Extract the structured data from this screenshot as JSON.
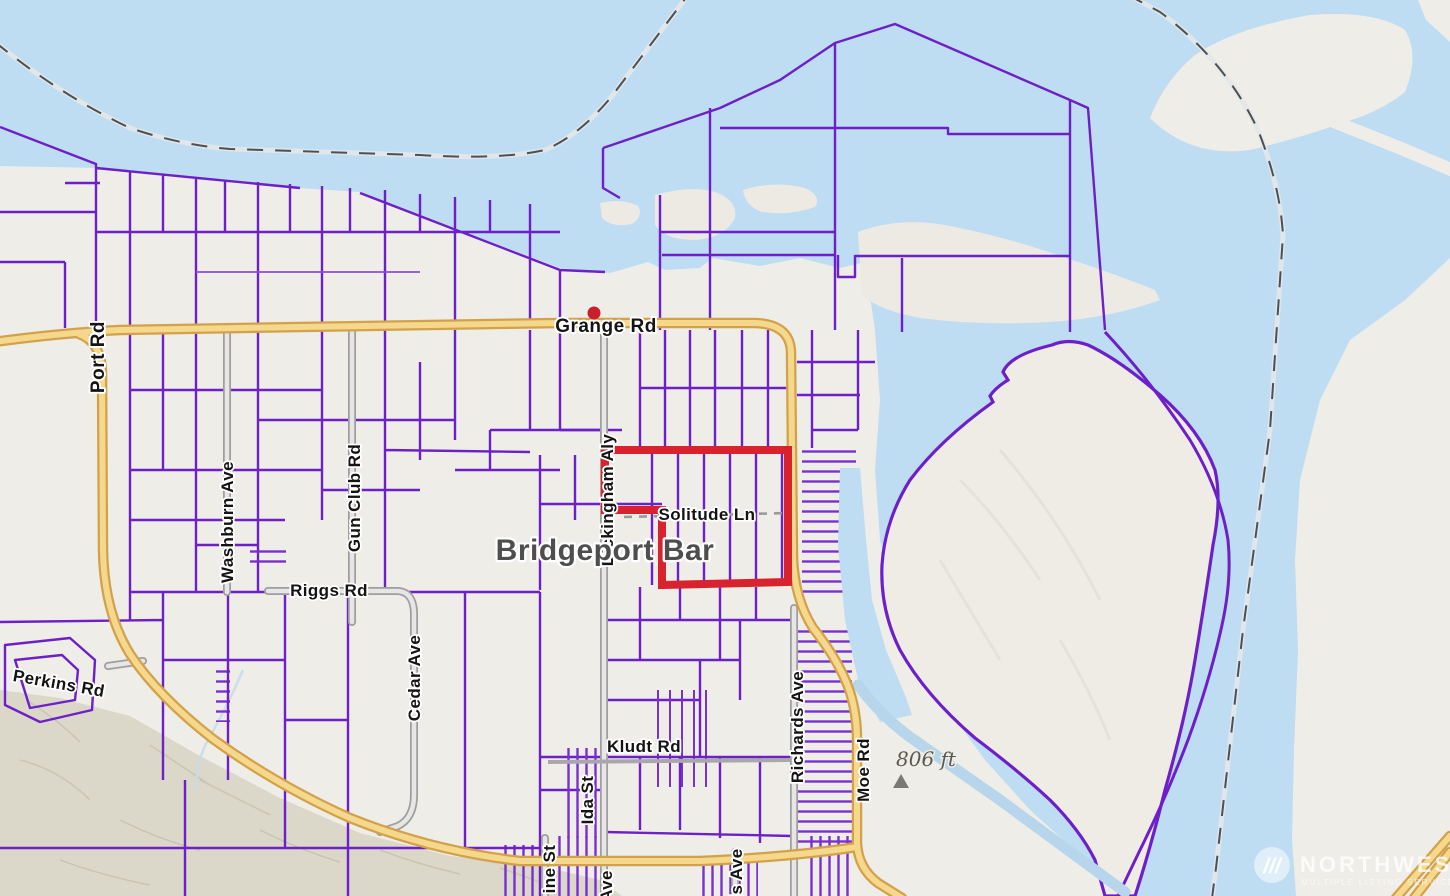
{
  "map": {
    "type": "parcel-map",
    "place_label": "Bridgeport Bar",
    "elevation_marker": {
      "text": "806 ft",
      "icon": "peak-triangle-icon"
    },
    "poi": {
      "marker": "red-dot-marker",
      "color": "#c92030"
    },
    "selected_parcel": {
      "outline_color": "#d8232f"
    },
    "road_labels": [
      {
        "id": "grange-rd",
        "text": "Grange Rd"
      },
      {
        "id": "port-rd",
        "text": "Port Rd"
      },
      {
        "id": "washburn-ave",
        "text": "Washburn Ave"
      },
      {
        "id": "gun-club-rd",
        "text": "Gun Club Rd"
      },
      {
        "id": "riggs-rd",
        "text": "Riggs Rd"
      },
      {
        "id": "cedar-ave",
        "text": "Cedar Ave"
      },
      {
        "id": "perkins-rd",
        "text": "Perkins Rd"
      },
      {
        "id": "dickingham-aly",
        "text": "Dickingham Aly"
      },
      {
        "id": "solitude-ln",
        "text": "Solitude Ln"
      },
      {
        "id": "kludt-rd",
        "text": "Kludt Rd"
      },
      {
        "id": "ida-st",
        "text": "Ida St"
      },
      {
        "id": "richards-ave",
        "text": "Richards Ave"
      },
      {
        "id": "moe-rd",
        "text": "Moe Rd"
      },
      {
        "id": "ine-st-partial",
        "text": "ine St"
      },
      {
        "id": "ave-partial",
        "text": "Ave"
      },
      {
        "id": "is-ave-partial",
        "text": "is Ave"
      }
    ],
    "colors": {
      "water": "#bedcf2",
      "land": "#efede7",
      "hill": "#d9d6c7",
      "parcel_line": "#6d1fc8",
      "parcel_line_light": "#8f4ae0",
      "road_major_fill": "#f6d88c",
      "road_major_casing": "#d2a14b",
      "road_minor_fill": "#e6e6e6",
      "road_minor_casing": "#9e9e9e",
      "selection_red": "#d8232f",
      "boundary_dash": "#4b5055"
    }
  },
  "watermark": {
    "brand": "NORTHWEST",
    "tagline": "MULTIPLE LISTING SERVICE",
    "icon": "triple-slash-logo-icon",
    "icon_glyph": "///"
  }
}
